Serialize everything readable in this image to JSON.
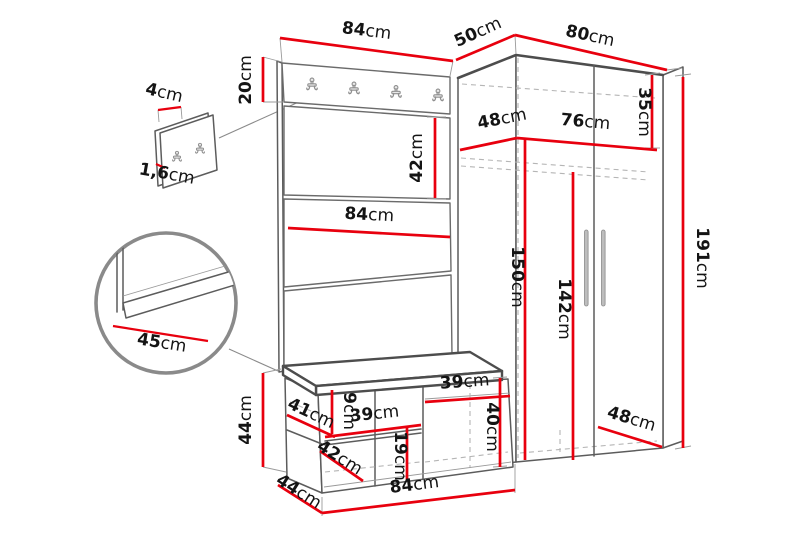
{
  "diagram": {
    "kind": "furniture-dimension-diagram",
    "subject": "hallway set: coat-rack panel with hooks, shoe bench and corner wardrobe",
    "unit": "cm",
    "accent_color": "#e8000e",
    "outline_color": "#5c5c5c",
    "background": "#ffffff",
    "panel_hook_count": 4,
    "detail_hook_count": 2
  },
  "icons": {
    "coat_hook": "coat-hook",
    "door_handle": "door-handle"
  },
  "labels": {
    "detail_thickness": {
      "v": "4",
      "u": "cm"
    },
    "detail_board_thickness": {
      "v": "1,6",
      "u": "cm"
    },
    "panel_width": {
      "v": "84",
      "u": "cm"
    },
    "panel_strip_height": {
      "v": "20",
      "u": "cm"
    },
    "panel_section_height": {
      "v": "42",
      "u": "cm"
    },
    "panel_mid_width": {
      "v": "84",
      "u": "cm"
    },
    "seat_depth": {
      "v": "45",
      "u": "cm"
    },
    "bench_height": {
      "v": "44",
      "u": "cm"
    },
    "bench_left_width": {
      "v": "41",
      "u": "cm"
    },
    "bench_opening_height": {
      "v": "9",
      "u": "cm"
    },
    "bench_mid_width": {
      "v": "39",
      "u": "cm"
    },
    "bench_lower_height": {
      "v": "19",
      "u": "cm"
    },
    "bench_lower_width": {
      "v": "42",
      "u": "cm"
    },
    "bench_depth": {
      "v": "44",
      "u": "cm"
    },
    "bench_width": {
      "v": "84",
      "u": "cm"
    },
    "bench_right_width": {
      "v": "39",
      "u": "cm"
    },
    "bench_right_height": {
      "v": "40",
      "u": "cm"
    },
    "wardrobe_top_depth": {
      "v": "50",
      "u": "cm"
    },
    "wardrobe_width": {
      "v": "80",
      "u": "cm"
    },
    "wardrobe_inner_depth": {
      "v": "48",
      "u": "cm"
    },
    "wardrobe_inner_width": {
      "v": "76",
      "u": "cm"
    },
    "wardrobe_top_section": {
      "v": "35",
      "u": "cm"
    },
    "wardrobe_left_inner_height": {
      "v": "150",
      "u": "cm"
    },
    "wardrobe_inner_height": {
      "v": "142",
      "u": "cm"
    },
    "wardrobe_bottom_depth": {
      "v": "48",
      "u": "cm"
    },
    "wardrobe_height": {
      "v": "191",
      "u": "cm"
    }
  }
}
